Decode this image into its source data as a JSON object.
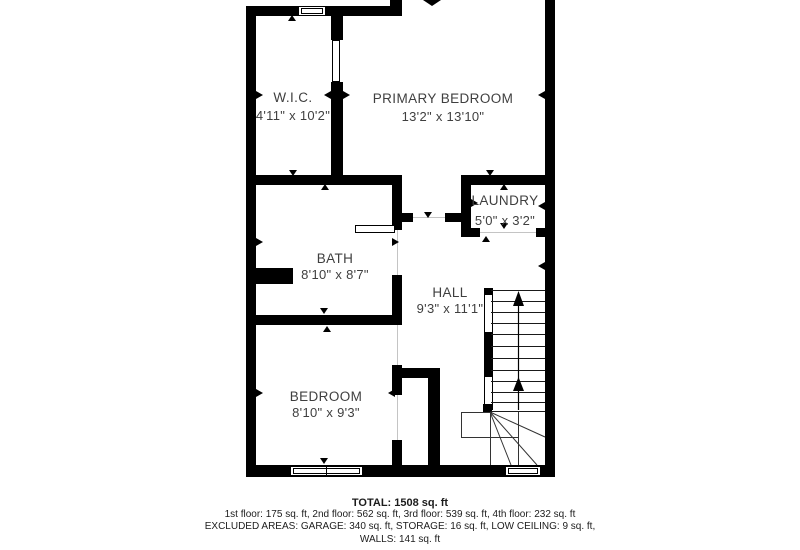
{
  "colors": {
    "wall": "#000000",
    "room_label": "#3f3f3f",
    "background": "#ffffff"
  },
  "rooms": [
    {
      "id": "wic",
      "name": "W.I.C.",
      "dimensions": "4'11\" x 10'2\""
    },
    {
      "id": "primary-bedroom",
      "name": "PRIMARY BEDROOM",
      "dimensions": "13'2\" x 13'10\""
    },
    {
      "id": "laundry",
      "name": "LAUNDRY",
      "dimensions": "5'0\" x 3'2\""
    },
    {
      "id": "bath",
      "name": "BATH",
      "dimensions": "8'10\" x 8'7\""
    },
    {
      "id": "hall",
      "name": "HALL",
      "dimensions": "9'3\" x 11'1\""
    },
    {
      "id": "bedroom",
      "name": "BEDROOM",
      "dimensions": "8'10\" x 9'3\""
    }
  ],
  "summary": {
    "total": "TOTAL: 1508 sq. ft",
    "floors": "1st floor: 175 sq. ft, 2nd floor: 562 sq. ft, 3rd floor: 539 sq. ft, 4th floor: 232 sq. ft",
    "excluded": "EXCLUDED AREAS: GARAGE: 340 sq. ft, STORAGE: 16 sq. ft, LOW CEILING: 9 sq. ft,",
    "walls": "WALLS: 141 sq. ft"
  }
}
